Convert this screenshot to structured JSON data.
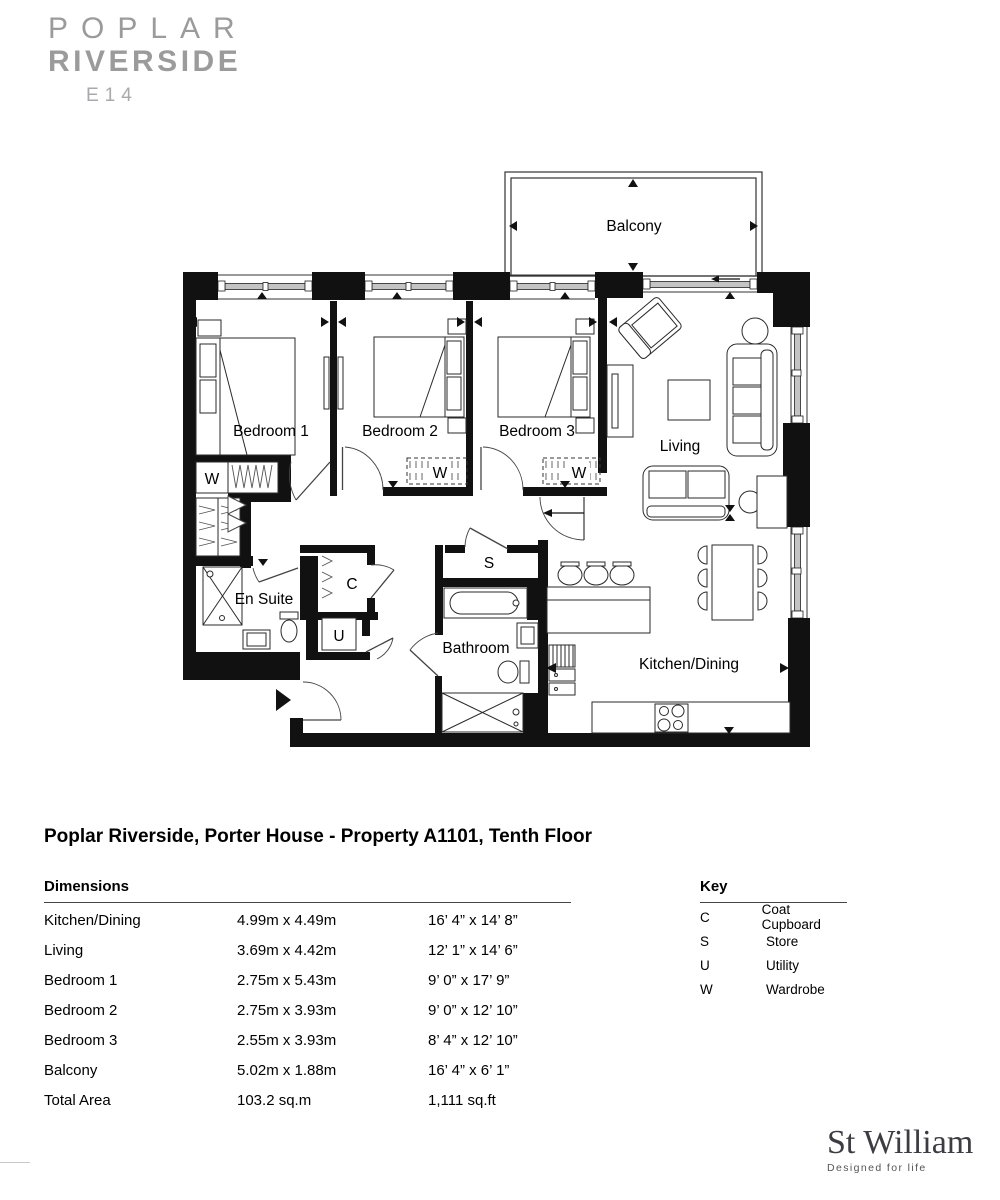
{
  "logo": {
    "line1": "POPLAR",
    "line2": "RIVERSIDE",
    "line3": "E14"
  },
  "page": {
    "title": "Poplar Riverside, Porter House - Property A1101, Tenth Floor"
  },
  "floorplan": {
    "labels": {
      "balcony": "Balcony",
      "bedroom1": "Bedroom 1",
      "bedroom2": "Bedroom 2",
      "bedroom3": "Bedroom 3",
      "living": "Living",
      "kitchen": "Kitchen/Dining",
      "bathroom": "Bathroom",
      "ensuite": "En Suite",
      "wardrobe": "W",
      "coat": "C",
      "store": "S",
      "utility": "U"
    }
  },
  "dimensions": {
    "heading": "Dimensions",
    "rows": [
      {
        "room": "Kitchen/Dining",
        "metric": "4.99m x 4.49m",
        "imperial": "16’ 4” x 14’ 8”"
      },
      {
        "room": "Living",
        "metric": "3.69m x 4.42m",
        "imperial": "12’ 1” x 14’ 6”"
      },
      {
        "room": "Bedroom 1",
        "metric": "2.75m x 5.43m",
        "imperial": "9’ 0” x 17’ 9”"
      },
      {
        "room": "Bedroom 2",
        "metric": "2.75m x 3.93m",
        "imperial": "9’ 0” x 12’ 10”"
      },
      {
        "room": "Bedroom 3",
        "metric": "2.55m x 3.93m",
        "imperial": "8’ 4” x 12’ 10”"
      },
      {
        "room": "Balcony",
        "metric": "5.02m x 1.88m",
        "imperial": "16’ 4” x 6’ 1”"
      },
      {
        "room": "Total Area",
        "metric": "103.2 sq.m",
        "imperial": "1,111 sq.ft"
      }
    ]
  },
  "key": {
    "heading": "Key",
    "items": [
      {
        "code": "C",
        "label": "Coat Cupboard"
      },
      {
        "code": "S",
        "label": "Store"
      },
      {
        "code": "U",
        "label": "Utility"
      },
      {
        "code": "W",
        "label": "Wardrobe"
      }
    ]
  },
  "brand": {
    "name": "St William",
    "tagline": "Designed for life"
  }
}
